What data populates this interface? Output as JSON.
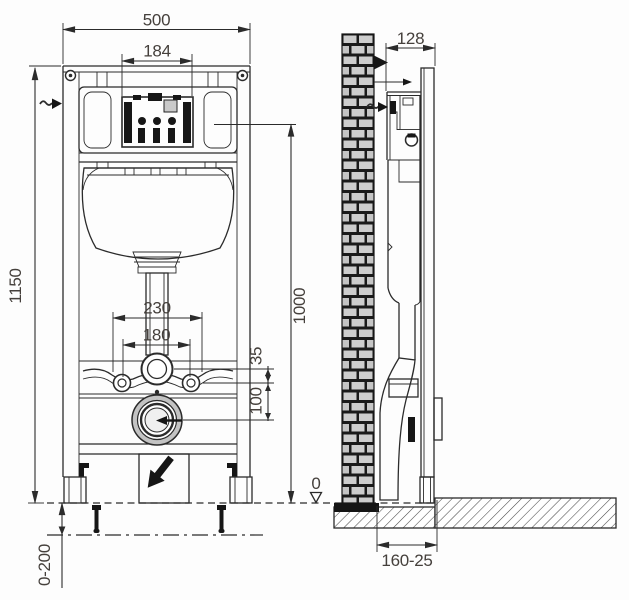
{
  "drawing": {
    "title": "Wall-mounted WC concealed cistern installation frame - dimensioned technical drawing",
    "front_view": {
      "width": "500",
      "flush_plate_width": "184",
      "frame_height": "1150",
      "flush_plate_height": "1000",
      "fixing_outer_width": "230",
      "fixing_centers": "180",
      "bend_to_bracket": "35",
      "bracket_to_drain": "100",
      "leg_adjustment": "0-200"
    },
    "side_view": {
      "frame_depth": "128",
      "floor_level": "0",
      "wall_to_drain": "160-25"
    },
    "icons": {
      "water_supply_arrow": "right-arrow-with-squiggle",
      "wall_fixing_arrow": "right-arrow-solid",
      "bracket_pointer_arrow": "right-arrow-solid",
      "drain_flow_arrow": "left-arrow-into-drain",
      "drain_direction_arrow": "down-left-bent-arrow",
      "floor_level_marker": "open-down-triangle"
    },
    "colors": {
      "line": "#2b2b2b",
      "text": "#45403c",
      "brick_fill": "#cdcdcd",
      "brick_joint": "#1a1a1a",
      "drain_ring": "#c3c3c3",
      "hatch": "#4a4a4a",
      "background": "#fdfdfd"
    }
  }
}
